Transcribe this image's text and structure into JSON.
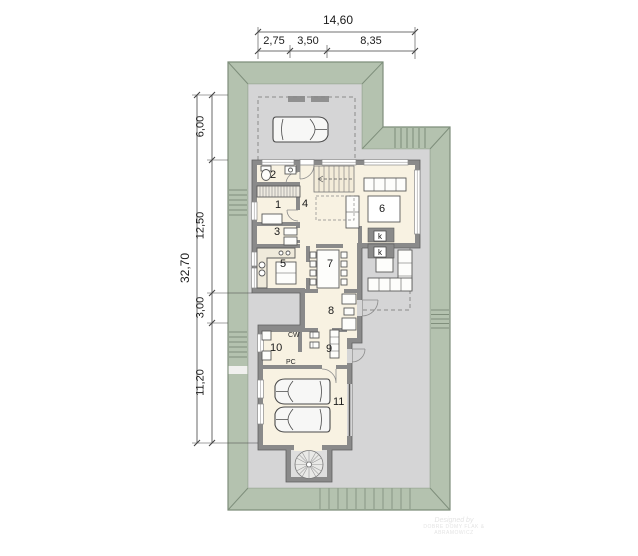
{
  "dimensions": {
    "top": {
      "total": "14,60",
      "segments": [
        "2,75",
        "3,50",
        "8,35"
      ]
    },
    "left": {
      "total": "32,70",
      "segments": [
        "6,00",
        "12,50",
        "3,00",
        "11,20"
      ]
    }
  },
  "rooms": [
    "1",
    "2",
    "3",
    "4",
    "5",
    "6",
    "7",
    "8",
    "9",
    "10",
    "11"
  ],
  "equipment": {
    "washer": "CW",
    "furnace": "PC",
    "duct": "k"
  },
  "watermark": {
    "line1": "Designed by",
    "line2": "DOBRE DOMY FLAK & ABRAMOWICZ"
  },
  "colors": {
    "roof_green": "#b4c2af",
    "paving_gray": "#d5d5d6",
    "wall_gray": "#8a8a8a",
    "interior_cream": "#f8f2e2"
  }
}
